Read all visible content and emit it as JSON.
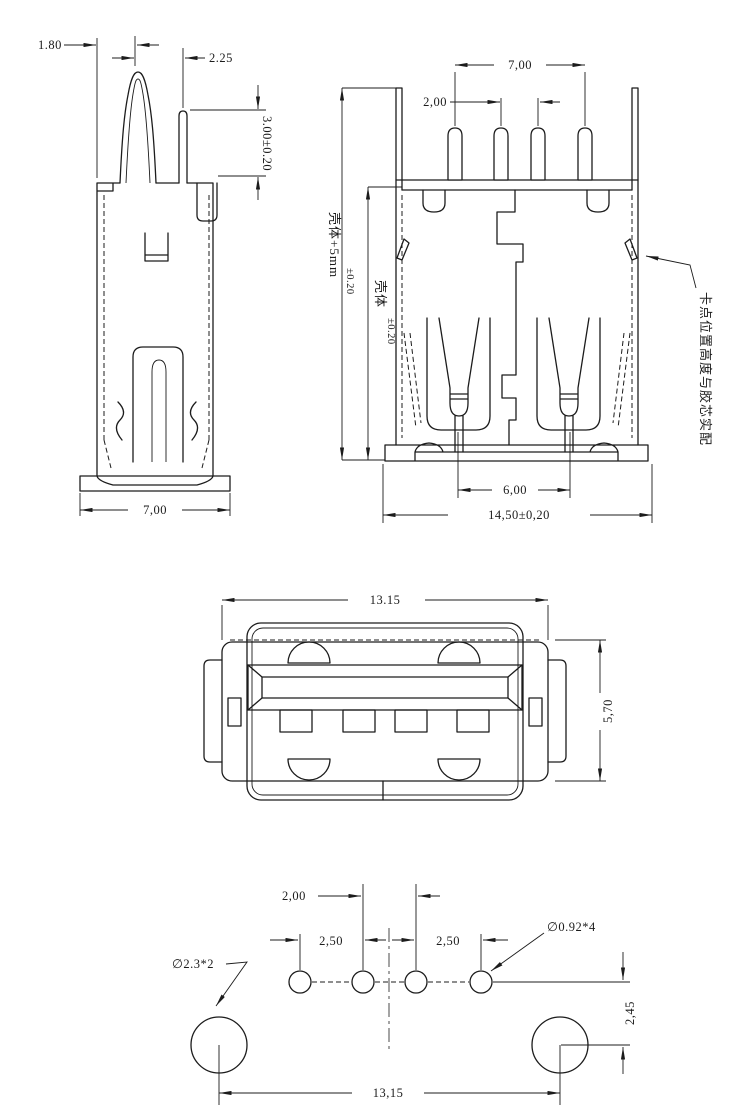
{
  "colors": {
    "background": "#ffffff",
    "line": "#1c1c1c"
  },
  "side_view": {
    "dim_pin_offset": "1.80",
    "dim_pin_gap": "2.25",
    "dim_pin_height": "3.00±0.20",
    "dim_base_width": "7,00"
  },
  "rear_view": {
    "dim_pin_span": "7,00",
    "dim_pin_pitch": "2,00",
    "dim_shell_plus": "壳体+5mm",
    "dim_shell_plus_tol": "±0.20",
    "dim_shell": "壳体",
    "dim_shell_tol": "±0.20",
    "dim_contact_span": "6,00",
    "dim_body_width": "14,50±0,20",
    "note": "卡点位置高度与胶芯实配"
  },
  "front_view": {
    "dim_width": "13.15",
    "dim_height": "5,70"
  },
  "footprint_view": {
    "dim_center_pitch": "2,00",
    "dim_left_pitch": "2,50",
    "dim_right_pitch": "2,50",
    "label_small_holes": "∅0.92*4",
    "label_big_holes": "∅2.3*2",
    "dim_hole_offset": "2,45",
    "dim_big_hole_span": "13,15"
  }
}
